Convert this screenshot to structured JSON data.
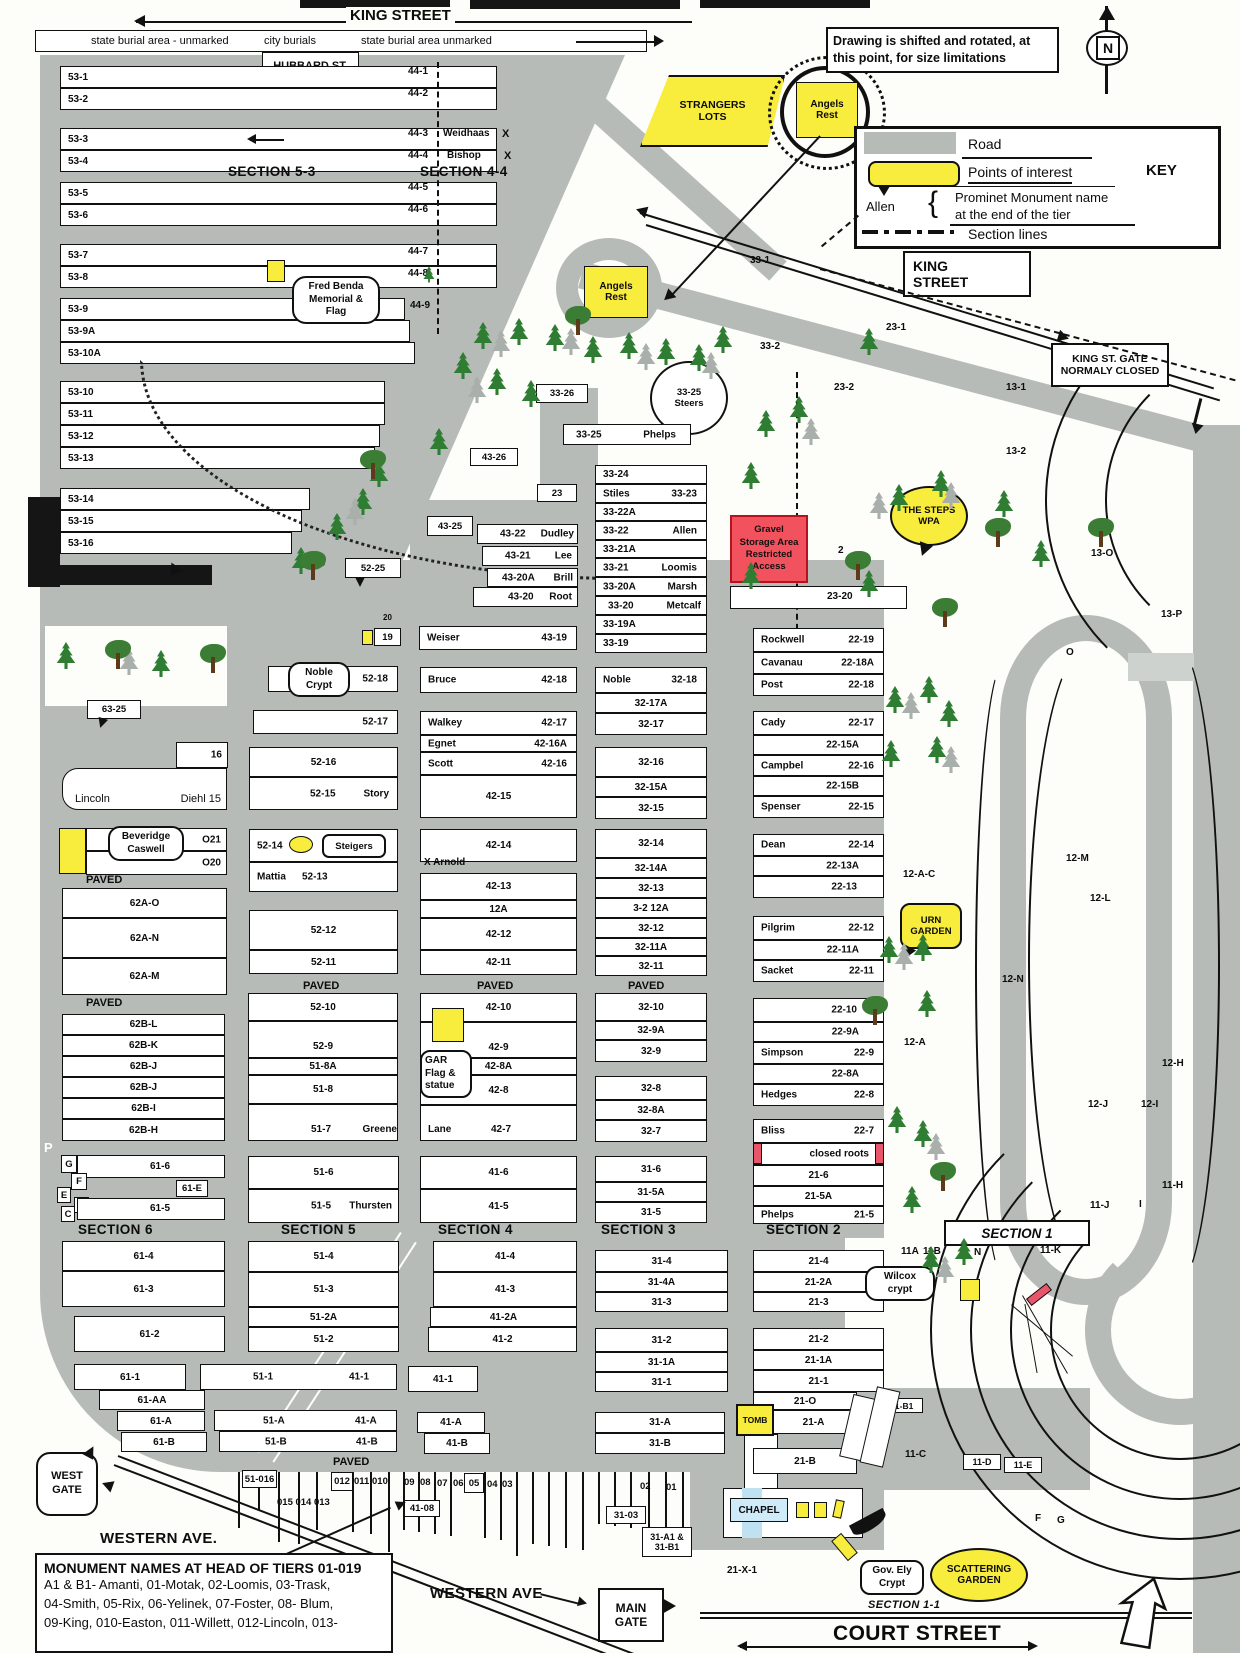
{
  "map": {
    "king_street_top": "KING STREET",
    "burial_band": [
      "state burial area - unmarked",
      "city burials",
      "state burial area unmarked"
    ],
    "hubbard_gate": [
      "HUBBARD ST.",
      "GATE"
    ],
    "note": "Drawing is shifted and rotated, at this point, for size limitations",
    "compass_n": "N",
    "key": {
      "road": "Road",
      "poi": "Points of interest",
      "title": "KEY",
      "allen": "Allen",
      "brace": "{",
      "mon1": "Prominet Monument name",
      "mon2": "at the end of the tier",
      "sections": "Section lines"
    },
    "king_box": [
      "KING",
      "STREET"
    ],
    "king_gate": [
      "KING ST. GATE",
      "NORMALY CLOSED"
    ],
    "paved": "PAVED"
  },
  "sections": {
    "s53": "SECTION 5-3",
    "s44": "SECTION 4-4",
    "s6": "SECTION 6",
    "s5": "SECTION 5",
    "s4": "SECTION 4",
    "s3": "SECTION 3",
    "s2": "SECTION 2",
    "s1": "SECTION 1",
    "s11": "SECTION 1-1"
  },
  "poi": {
    "strangers": [
      "STRANGERS",
      "LOTS"
    ],
    "angels": [
      "Angels",
      "Rest"
    ],
    "steers": [
      "33-25",
      "Steers"
    ],
    "fred": [
      "Fred Benda",
      "Memorial &",
      "Flag"
    ],
    "noble": [
      "Noble",
      "Crypt"
    ],
    "steigers": "Steigers",
    "gravel": [
      "Gravel",
      "Storage Area",
      "Restricted",
      "Access"
    ],
    "steps": [
      "THE STEPS",
      "WPA"
    ],
    "urn": [
      "URN",
      "GARDEN"
    ],
    "gar": [
      "GAR",
      "Flag &",
      "statue"
    ],
    "bev": [
      "Beveridge",
      "Caswell"
    ],
    "wilcox": [
      "Wilcox",
      "crypt"
    ],
    "tomb": "TOMB",
    "chapel": "CHAPEL",
    "govely": [
      "Gov. Ely",
      "Crypt"
    ],
    "scatter": [
      "SCATTERING",
      "GARDEN"
    ],
    "west_gate": [
      "WEST",
      "GATE"
    ],
    "main_gate": [
      "MAIN",
      "GATE"
    ]
  },
  "streets": {
    "western1": "WESTERN AVE.",
    "western2": "WESTERN AVE",
    "court": "COURT STREET"
  },
  "c53": [
    {
      "l": "53-1"
    },
    {
      "l": "53-2"
    },
    {
      "l": "53-3"
    },
    {
      "l": "53-4"
    },
    {
      "l": "53-5"
    },
    {
      "l": "53-6"
    },
    {
      "l": "53-7"
    },
    {
      "l": "53-8"
    },
    {
      "l": "53-9"
    },
    {
      "l": "53-9A"
    },
    {
      "l": "53-10A"
    },
    {
      "l": "53-10"
    },
    {
      "l": "53-11"
    },
    {
      "l": "53-12"
    },
    {
      "l": "53-13"
    },
    {
      "l": "53-14"
    },
    {
      "l": "53-15"
    },
    {
      "l": "53-16"
    }
  ],
  "c44": [
    "44-1",
    "44-2",
    "44-3",
    "44-4",
    "44-5",
    "44-6",
    "44-7",
    "44-8",
    "44-9"
  ],
  "mon44": {
    "w": "Weidhaas",
    "b": "Bishop",
    "x": "X"
  },
  "c33": [
    {
      "a": "33-24"
    },
    {
      "a": "Stiles",
      "b": "33-23"
    },
    {
      "a": "33-22A"
    },
    {
      "a": "33-22",
      "b": "Allen"
    },
    {
      "a": "33-21A"
    },
    {
      "a": "33-21",
      "b": "Loomis"
    },
    {
      "a": "33-20A",
      "b": "Marsh"
    },
    {
      "a": "33-20",
      "b": "Metcalf"
    },
    {
      "a": "33-19A"
    },
    {
      "a": "33-19"
    }
  ],
  "c43": [
    {
      "a": "43-22",
      "b": "Dudley"
    },
    {
      "a": "43-21",
      "b": "Lee"
    },
    {
      "a": "43-20A",
      "b": "Brill"
    },
    {
      "a": "43-20",
      "b": "Root"
    },
    {
      "a": "Weiser",
      "b": "43-19"
    }
  ],
  "c52": [
    {
      "a": "52-18"
    },
    {
      "a": "52-17"
    },
    {
      "a": "52-16"
    },
    {
      "a": "52-15",
      "b": "Story"
    },
    {
      "a": "52-14"
    },
    {
      "a": "Mattia",
      "b": "52-13"
    },
    {
      "a": "52-12"
    },
    {
      "a": "52-11"
    },
    {
      "a": "52-10"
    },
    {
      "a": "52-9"
    },
    {
      "a": "51-8A"
    },
    {
      "a": "51-8"
    },
    {
      "a": "51-7",
      "b": "Greene"
    },
    {
      "a": "51-6"
    },
    {
      "a": "51-5",
      "b": "Thursten"
    },
    {
      "a": "51-4"
    },
    {
      "a": "51-3"
    },
    {
      "a": "51-2A"
    },
    {
      "a": "51-2"
    }
  ],
  "c42": [
    {
      "a": "Bruce",
      "b": "42-18"
    },
    {
      "a": "Walkey",
      "b": "42-17"
    },
    {
      "a": "Egnet",
      "b": "42-16A"
    },
    {
      "a": "Scott",
      "b": "42-16"
    },
    {
      "a": "42-15"
    },
    {
      "a": "42-14"
    },
    {
      "a": "X Arnold"
    },
    {
      "a": "42-13"
    },
    {
      "a": "12A"
    },
    {
      "a": "42-12"
    },
    {
      "a": "42-11"
    },
    {
      "a": "42-10"
    },
    {
      "a": "42-9"
    },
    {
      "a": "42-8A"
    },
    {
      "a": "42-8"
    },
    {
      "a": "Lane",
      "b": "42-7"
    },
    {
      "a": "41-6"
    },
    {
      "a": "41-5"
    },
    {
      "a": "41-4"
    },
    {
      "a": "41-3"
    },
    {
      "a": "41-2A"
    },
    {
      "a": "41-2"
    }
  ],
  "c32": [
    {
      "a": "Noble",
      "b": "32-18"
    },
    {
      "a": "32-17A"
    },
    {
      "a": "32-17"
    },
    {
      "a": "32-16"
    },
    {
      "a": "32-15A"
    },
    {
      "a": "32-15"
    },
    {
      "a": "32-14"
    },
    {
      "a": "32-14A"
    },
    {
      "a": "32-13"
    },
    {
      "a": "3-2 12A"
    },
    {
      "a": "32-12"
    },
    {
      "a": "32-11A"
    },
    {
      "a": "32-11"
    },
    {
      "a": "32-10"
    },
    {
      "a": "32-9A"
    },
    {
      "a": "32-9"
    },
    {
      "a": "32-8"
    },
    {
      "a": "32-8A"
    },
    {
      "a": "32-7"
    },
    {
      "a": "31-6"
    },
    {
      "a": "31-5A"
    },
    {
      "a": "31-5"
    },
    {
      "a": "31-4"
    },
    {
      "a": "31-4A"
    },
    {
      "a": "31-3"
    },
    {
      "a": "31-2"
    },
    {
      "a": "31-1A"
    },
    {
      "a": "31-1"
    },
    {
      "a": "31-A"
    },
    {
      "a": "31-B"
    }
  ],
  "c22": [
    {
      "a": "Rockwell",
      "b": "22-19"
    },
    {
      "a": "Cavanau",
      "b": "22-18A"
    },
    {
      "a": "Post",
      "b": "22-18"
    },
    {
      "a": "Cady",
      "b": "22-17"
    },
    {
      "b": "22-15A"
    },
    {
      "a": "Campbel",
      "b": "22-16"
    },
    {
      "b": "22-15B"
    },
    {
      "a": "Spenser",
      "b": "22-15"
    },
    {
      "a": "Dean",
      "b": "22-14"
    },
    {
      "b": "22-13A"
    },
    {
      "b": "22-13"
    },
    {
      "a": "Pilgrim",
      "b": "22-12"
    },
    {
      "b": "22-11A"
    },
    {
      "a": "Sacket",
      "b": "22-11"
    },
    {
      "b": "22-10"
    },
    {
      "b": "22-9A"
    },
    {
      "a": "Simpson",
      "b": "22-9"
    },
    {
      "b": "22-8A"
    },
    {
      "a": "Hedges",
      "b": "22-8"
    },
    {
      "a": "Bliss",
      "b": "22-7"
    },
    {
      "b": "closed roots"
    },
    {
      "a": "21-6"
    },
    {
      "a": "21-5A"
    },
    {
      "a": "Phelps",
      "b": "21-5"
    },
    {
      "a": "21-4"
    },
    {
      "a": "21-2A"
    },
    {
      "a": "21-3"
    },
    {
      "a": "21-2"
    },
    {
      "a": "21-1A"
    },
    {
      "a": "21-1"
    },
    {
      "a": "21-O"
    },
    {
      "a": "21-A"
    },
    {
      "a": "21-B"
    }
  ],
  "cL": {
    "n16": "16",
    "lincoln": "Lincoln",
    "diehl": "Diehl 15",
    "o21": "O21",
    "o20": "O20",
    "a_o": "62A-O",
    "a_n": "62A-N",
    "a_m": "62A-M",
    "b_l": "62B-L",
    "b_k": "62B-K",
    "b_j1": "62B-J",
    "b_j2": "62B-J",
    "b_i": "62B-I",
    "b_h": "62B-H",
    "t6": "61-6",
    "t6e": "61-E",
    "t5": "61-5",
    "t4": "61-4",
    "t3": "61-3",
    "t2": "61-2",
    "t1": "61-1",
    "taa": "61-AA",
    "ta": "61-A",
    "tb": "61-B",
    "p": "P"
  },
  "small_boxes": [
    "G",
    "F",
    "E",
    "D",
    "C"
  ],
  "bot": {
    "a1": "51-1",
    "a2": "41-1",
    "a3": "41-1",
    "b1": "51-A",
    "b2": "41-A",
    "b3": "41-A",
    "c1": "51-B",
    "c2": "41-B",
    "c3": "41-B"
  },
  "strip": {
    "s016": "51-016",
    "s015": "015 014 013",
    "s012": "012",
    "s011": "011",
    "s010": "010",
    "s09": "09",
    "s08": "08",
    "s07": "07",
    "s06": "06",
    "s05": "05",
    "s04": "04",
    "s03": "03",
    "s02": "02",
    "s01": "01",
    "s4108": "41-08",
    "s3103": "31-03",
    "s31ab": "31-A1 &",
    "s31b1": "31-B1",
    "s21x1": "21-X-1"
  },
  "rl": [
    {
      "t": "33-1"
    },
    {
      "t": "23-1"
    },
    {
      "t": "33-2"
    },
    {
      "t": "23-2"
    },
    {
      "t": "13-1"
    },
    {
      "t": "13-2"
    },
    {
      "t": "13-O"
    },
    {
      "t": "13-P"
    },
    {
      "t": "O"
    },
    {
      "t": "12-M"
    },
    {
      "t": "12-L"
    },
    {
      "t": "12-N"
    },
    {
      "t": "12-A-C"
    },
    {
      "t": "12-A"
    },
    {
      "t": "12-H"
    },
    {
      "t": "12-J"
    },
    {
      "t": "12-I"
    },
    {
      "t": "11-H"
    },
    {
      "t": "11-J"
    },
    {
      "t": "I"
    },
    {
      "t": "11-K"
    },
    {
      "t": "N"
    },
    {
      "t": "11A"
    },
    {
      "t": "11B"
    },
    {
      "t": "11A"
    },
    {
      "t": "11B"
    },
    {
      "t": "11-C"
    },
    {
      "t": "F"
    },
    {
      "t": "G"
    },
    {
      "t": "2"
    }
  ],
  "misc": {
    "n23": "23",
    "n25": "25",
    "n20": "20",
    "n19": "19",
    "b3326": "33-26",
    "b4326": "43-26",
    "b4325": "43-25",
    "b5225": "52-25",
    "b6325": "63-25",
    "phelps1": "33-25",
    "phelps2": "Phelps",
    "p2320": "23-20",
    "b11b1": "11-B1",
    "b11d": "11-D",
    "b11e": "11-E"
  },
  "monument_note": {
    "title": "MONUMENT NAMES AT HEAD OF TIERS 01-019",
    "l1": "A1 & B1- Amanti, 01-Motak, 02-Loomis,  03-Trask,",
    "l2": "04-Smith, 05-Rix, 06-Yelinek,  07-Foster, 08- Blum,",
    "l3": "09-King,  010-Easton, 011-Willett,  012-Lincoln, 013-"
  }
}
